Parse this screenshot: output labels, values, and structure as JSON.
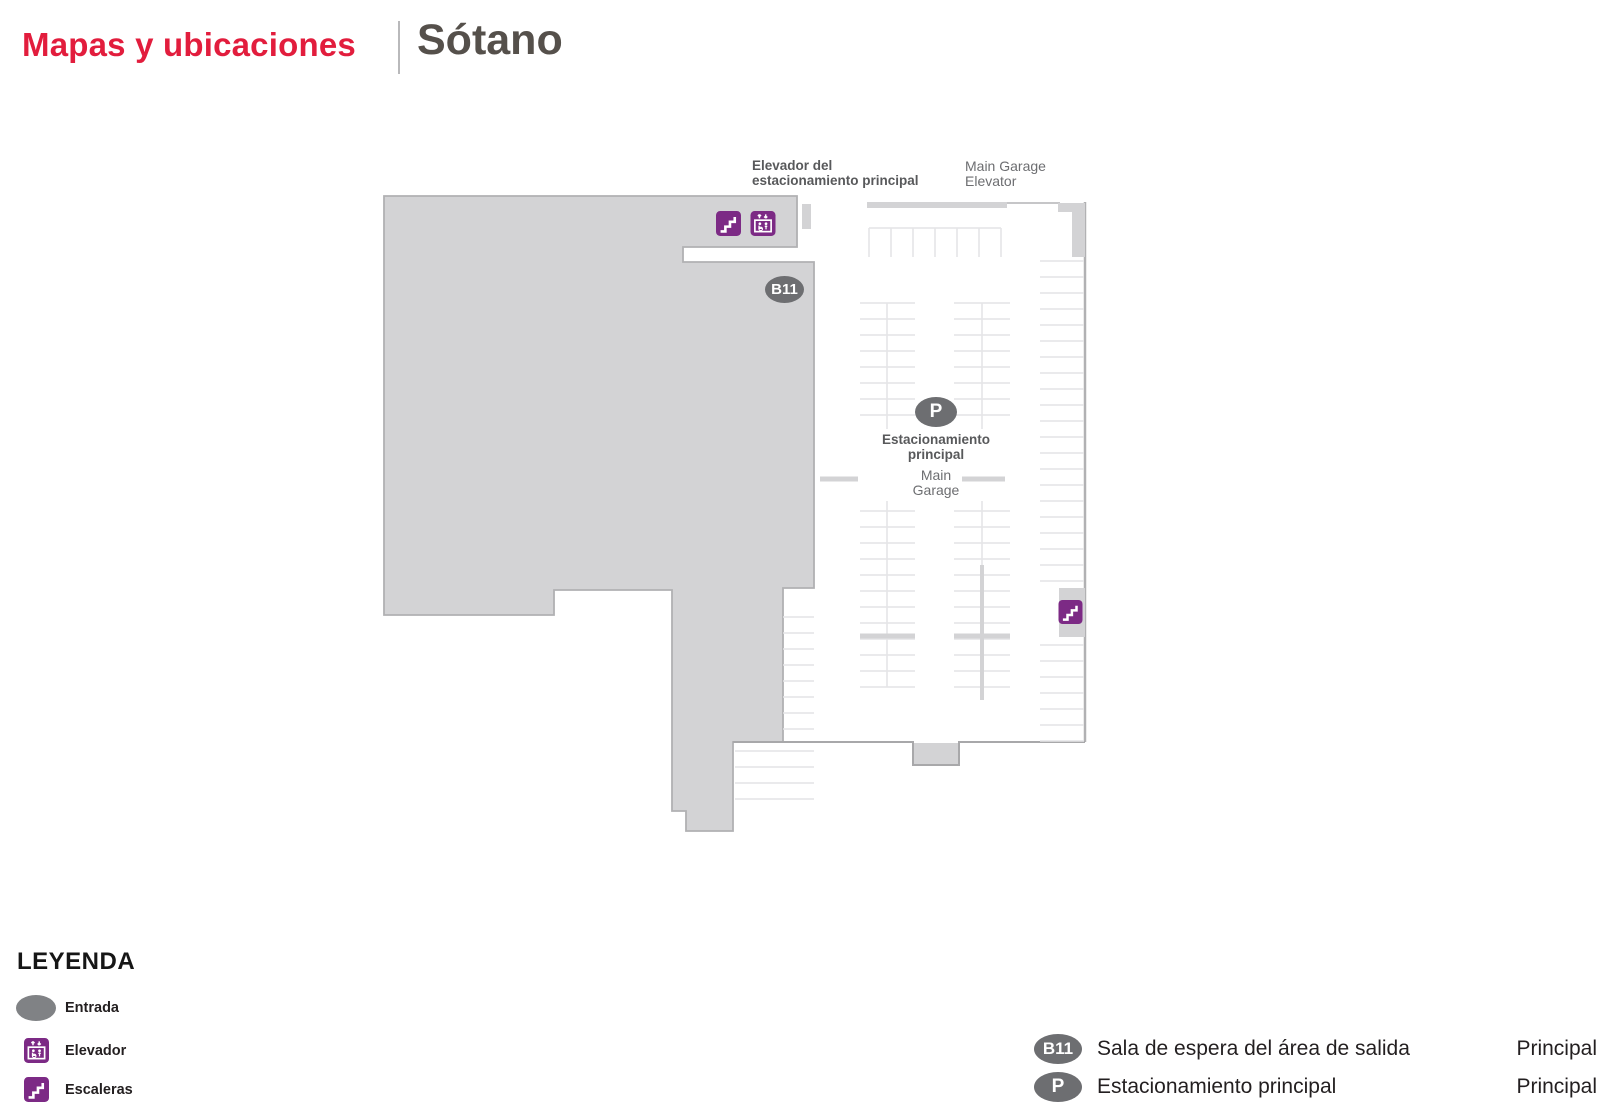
{
  "header": {
    "section_title": "Mapas y ubicaciones",
    "page_title": "Sótano"
  },
  "map": {
    "labels": {
      "garage_elevator_es": "Elevador del\nestacionamiento principal",
      "garage_elevator_en": "Main Garage\nElevator",
      "gate_badge": "B11",
      "parking_badge": "P",
      "parking_name_es": "Estacionamiento\nprincipal",
      "parking_name_en": "Main\nGarage"
    },
    "icons": {
      "stairs": "stairs-icon",
      "elevator": "elevator-icon"
    }
  },
  "legend": {
    "title": "LEYENDA",
    "items": [
      {
        "label": "Entrada"
      },
      {
        "label": "Elevador"
      },
      {
        "label": "Escaleras"
      }
    ]
  },
  "locations": [
    {
      "badge": "B11",
      "name": "Sala de espera del área de salida",
      "terminal": "Principal"
    },
    {
      "badge": "P",
      "name": "Estacionamiento principal",
      "terminal": "Principal"
    }
  ],
  "colors": {
    "accent_red": "#e21d3d",
    "title_gray": "#55504b",
    "icon_purple": "#7c2a85",
    "badge_gray": "#6d6e71",
    "entrance_gray": "#808285",
    "map_fill_gray": "#d3d3d5",
    "map_outline_gray": "#b1b1b3",
    "stall_line_gray": "#e4e4e6"
  }
}
